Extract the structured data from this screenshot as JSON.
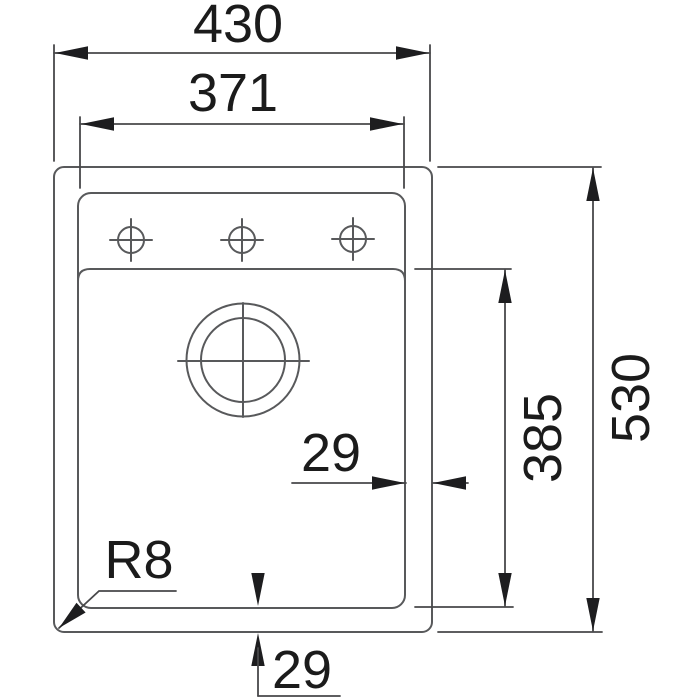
{
  "drawing": {
    "type": "sink-top-view-dimension-drawing",
    "colors": {
      "outline": "#58595b",
      "dimension": "#48484a",
      "arrow_and_text": "#1d1d1f",
      "background": "#ffffff"
    },
    "features": {
      "faucet_holes": 3,
      "drain": 1
    },
    "labels": {
      "overall_width": "430",
      "bowl_width": "371",
      "overall_depth": "530",
      "bowl_depth": "385",
      "rim_right": "29",
      "rim_bottom": "29",
      "corner_radius": "R8"
    }
  }
}
